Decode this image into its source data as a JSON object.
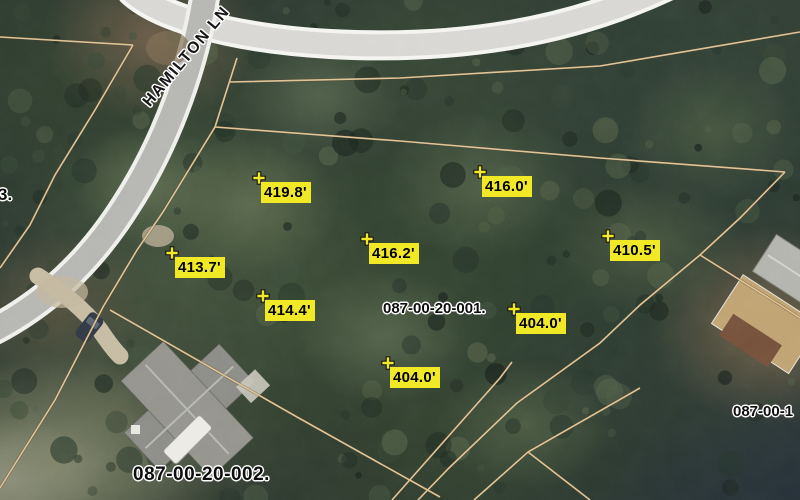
{
  "view": {
    "type": "aerial-parcel-map"
  },
  "road": {
    "name": "HAMILTON LN"
  },
  "parcels": {
    "labels": [
      {
        "id": "087-00-20-001."
      },
      {
        "id": "087-00-20-002."
      },
      {
        "id": "087-00-1"
      },
      {
        "id": "3."
      }
    ]
  },
  "elevations": [
    {
      "value": "419.8'"
    },
    {
      "value": "416.0'"
    },
    {
      "value": "413.7'"
    },
    {
      "value": "416.2'"
    },
    {
      "value": "410.5'"
    },
    {
      "value": "414.4'"
    },
    {
      "value": "404.0'"
    },
    {
      "value": "404.0'"
    }
  ],
  "colors": {
    "label_background": "#f2e926",
    "label_text": "#000000",
    "parcel_line": "#dfc293",
    "road_surface": "#d8d7d3",
    "road_edge": "#f4f4f1"
  }
}
